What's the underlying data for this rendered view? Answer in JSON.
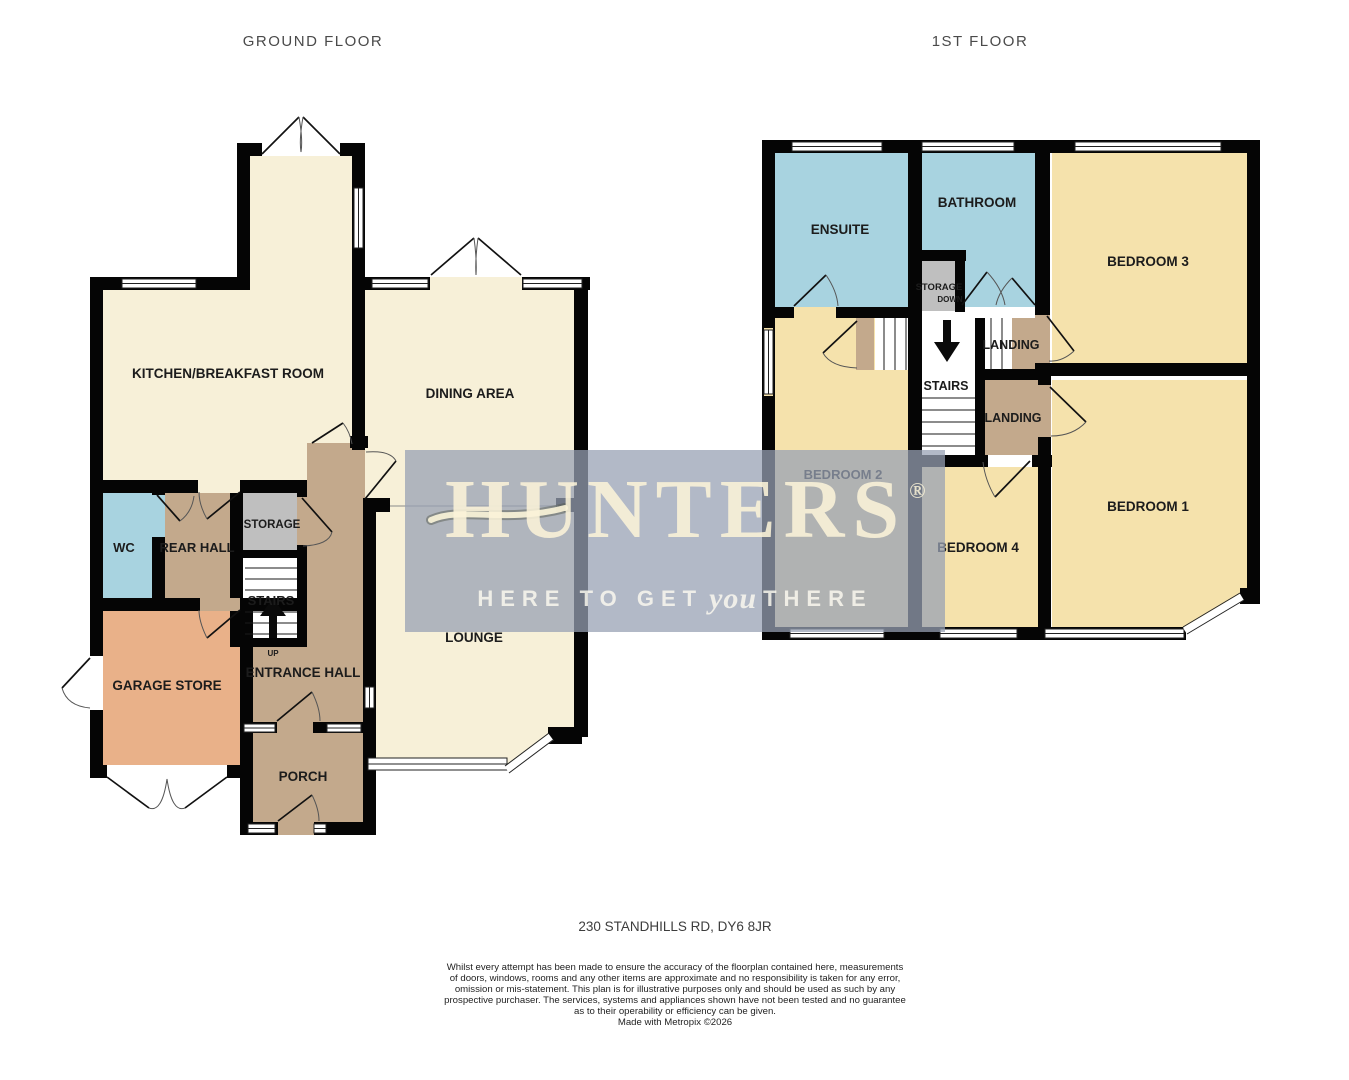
{
  "floors": {
    "ground": {
      "title": "GROUND FLOOR",
      "rooms": {
        "kitchen": "KITCHEN/BREAKFAST ROOM",
        "dining": "DINING AREA",
        "wc": "WC",
        "rear_hall": "REAR HALL",
        "storage": "STORAGE",
        "stairs": "STAIRS",
        "up": "UP",
        "garage": "GARAGE STORE",
        "entrance_hall": "ENTRANCE HALL",
        "lounge": "LOUNGE",
        "porch": "PORCH"
      }
    },
    "first": {
      "title": "1ST FLOOR",
      "rooms": {
        "ensuite": "ENSUITE",
        "bathroom": "BATHROOM",
        "bedroom3": "BEDROOM 3",
        "storage": "STORAGE",
        "down": "DOWN",
        "stairs": "STAIRS",
        "landing_upper": "LANDING",
        "landing_lower": "LANDING",
        "bedroom2": "BEDROOM 2",
        "bedroom4": "BEDROOM 4",
        "bedroom1": "BEDROOM 1"
      }
    }
  },
  "watermark": {
    "brand": "HUNTERS",
    "registered": "®",
    "tagline": {
      "pre": "HERE TO GET",
      "emphasis": "you",
      "post": "THERE"
    }
  },
  "footer": {
    "address": "230 STANDHILLS RD, DY6 8JR",
    "disclaimer_lines": [
      "Whilst every attempt has been made to ensure the accuracy of the floorplan contained here, measurements",
      "of doors, windows, rooms and any other items are approximate and no responsibility is taken for any error,",
      "omission or mis-statement. This plan is for illustrative purposes only and should be used as such by any",
      "prospective purchaser. The services, systems and appliances shown have not been tested and no guarantee",
      "as to their operability or efficiency can be given."
    ],
    "credit_line": "Made with Metropix ©2026"
  },
  "colors": {
    "floor_cream": "#F7F0D8",
    "bedroom_yellow": "#F5E2AC",
    "bath_blue": "#A8D3E0",
    "hall_tan": "#C3A98C",
    "garage_orange": "#E9B189",
    "storage_grey": "#BFBFBF",
    "wall_black": "#050505",
    "watermark_backdrop": "rgba(151,160,180,0.74)",
    "watermark_text_cream": "rgba(250,243,216,0.9)"
  }
}
